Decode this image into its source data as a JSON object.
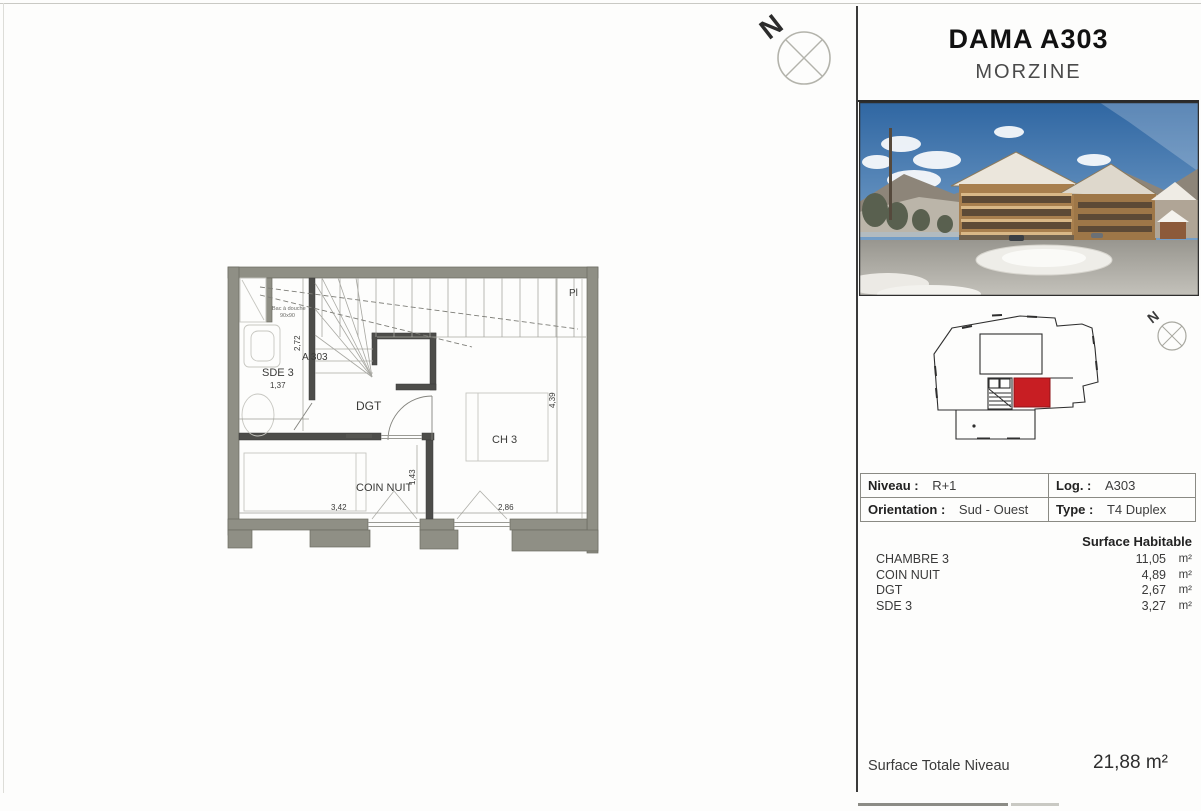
{
  "north": {
    "label": "N"
  },
  "plan": {
    "labels": {
      "pl": "Pl",
      "unit": "A 303",
      "sde3": "SDE 3",
      "dgt": "DGT",
      "ch3": "CH 3",
      "coin_nuit": "COIN NUIT",
      "shower_line1": "Bac à douche",
      "shower_line2": "90x90"
    },
    "dimensions": {
      "sde3_width": "1,37",
      "sde3_height": "2,72",
      "coin_width": "3,42",
      "coin_height": "1,43",
      "ch3_width": "2,86",
      "ch3_height": "4,39"
    }
  },
  "sidebar": {
    "title": "DAMA A303",
    "subtitle": "MORZINE",
    "info_table": {
      "niveau_label": "Niveau :",
      "niveau_value": "R+1",
      "log_label": "Log. :",
      "log_value": "A303",
      "orientation_label": "Orientation :",
      "orientation_value": "Sud - Ouest",
      "type_label": "Type :",
      "type_value": "T4 Duplex"
    },
    "surface_table": {
      "header": "Surface Habitable",
      "rows": [
        {
          "name": "CHAMBRE 3",
          "value": "11,05",
          "unit": "m²"
        },
        {
          "name": "COIN NUIT",
          "value": "4,89",
          "unit": "m²"
        },
        {
          "name": "DGT",
          "value": "2,67",
          "unit": "m²"
        },
        {
          "name": "SDE 3",
          "value": "3,27",
          "unit": "m²"
        }
      ]
    },
    "total": {
      "label": "Surface Totale Niveau",
      "value": "21,88 m²"
    },
    "colors": {
      "highlight_red": "#c81e23"
    }
  }
}
